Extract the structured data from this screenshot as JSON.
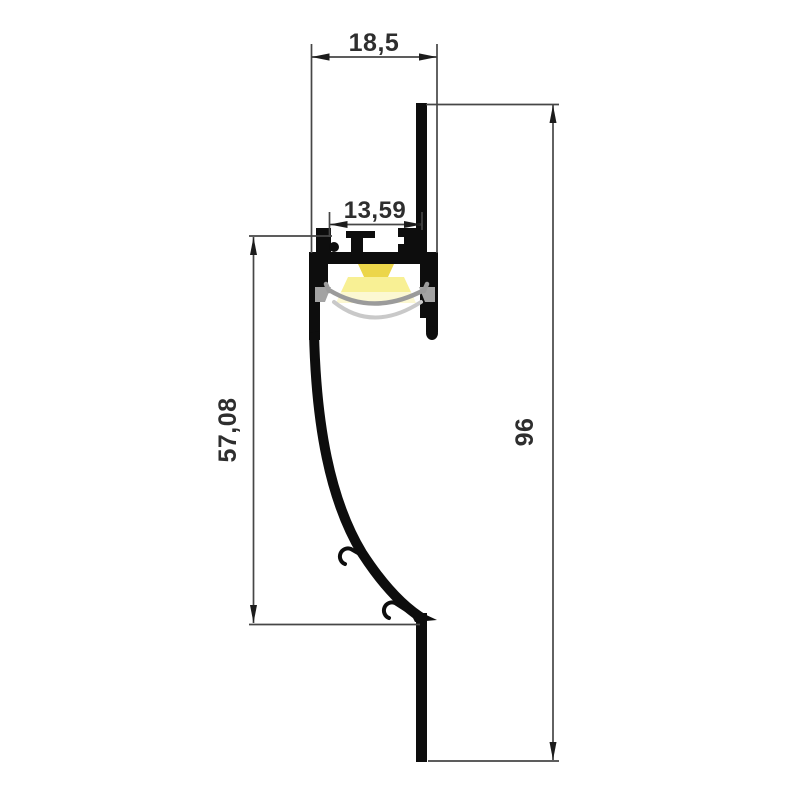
{
  "drawing": {
    "dimensions": {
      "top_width": "18,5",
      "inner_width": "13,59",
      "recess_height": "57,08",
      "overall_height": "96"
    },
    "palette": {
      "background": "#ffffff",
      "profile_outline": "#0d0d0d",
      "dimension_lines": "#464646",
      "dimension_text": "#2e2e2e",
      "diffuser_gray": "#9b9b9b",
      "inner_shadow_gray": "#c9c9c9",
      "ledge_gray": "#a3a3a3",
      "light_glow_outer": "#fcf8d2",
      "light_glow_mid": "#f8f094",
      "light_core_yellow": "#ecd64a"
    }
  }
}
